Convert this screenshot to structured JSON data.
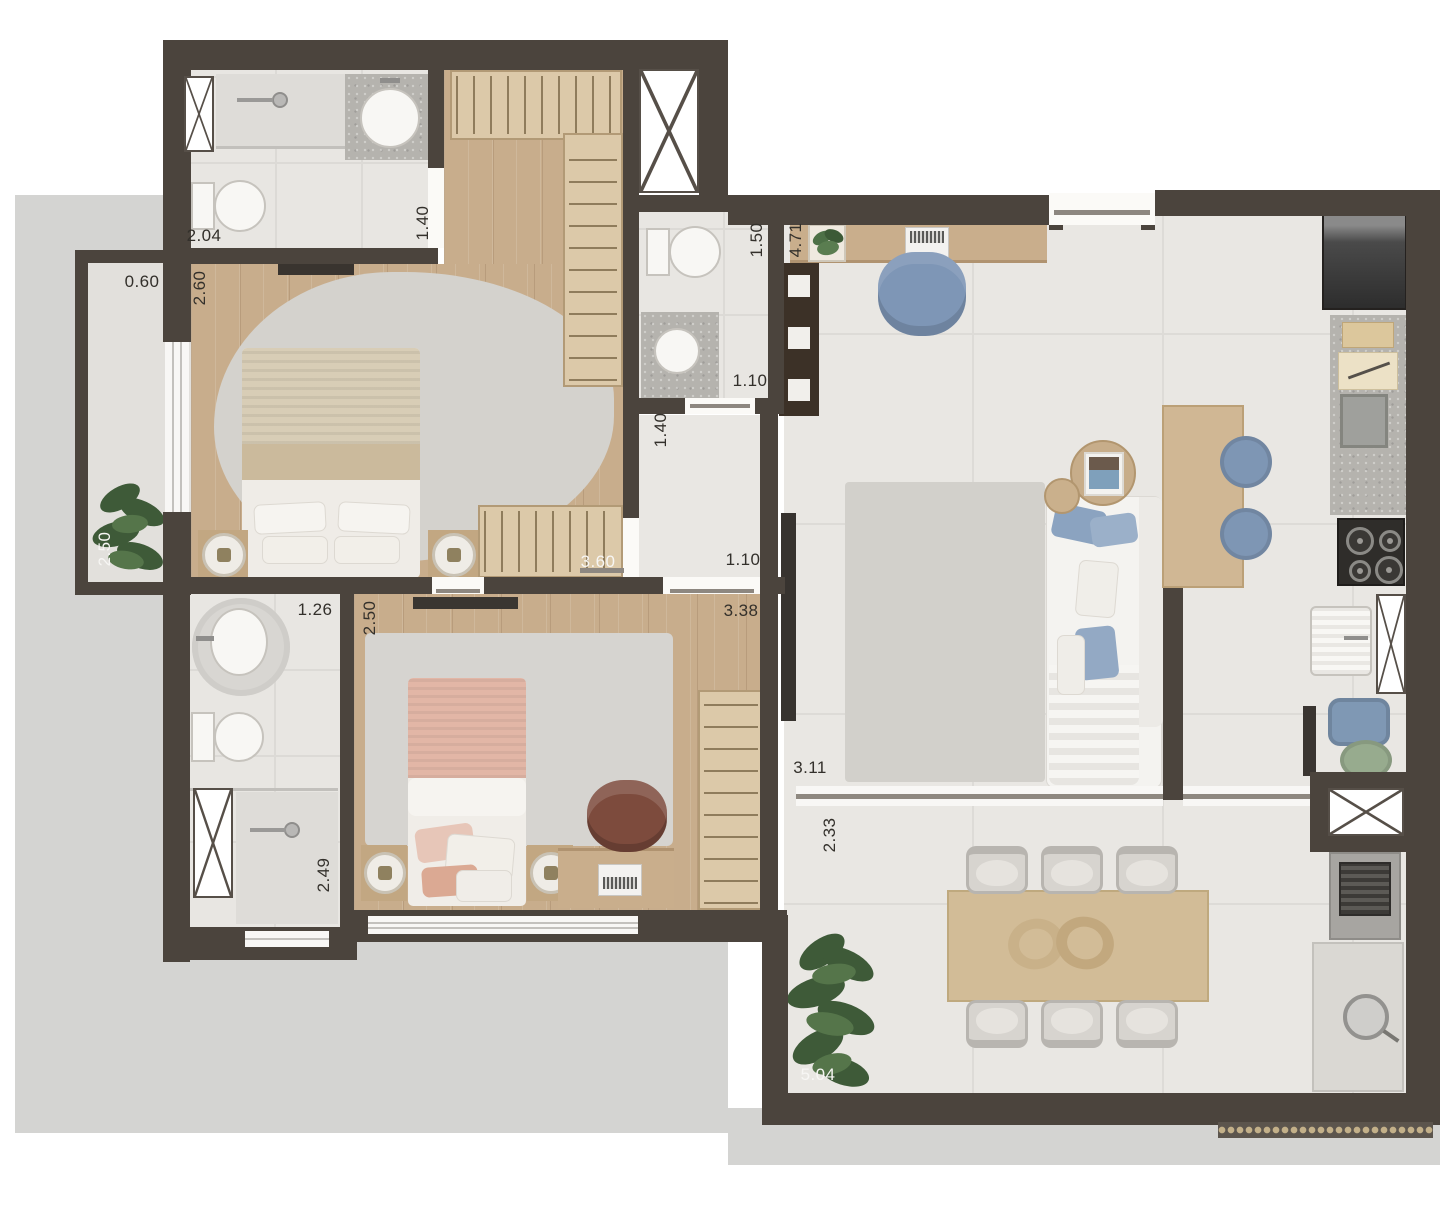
{
  "plan_type": "apartment-floor-plan",
  "dims": [
    {
      "text": "2.04",
      "orientation": "horizontal",
      "color": "dark",
      "area": "bathroom-1"
    },
    {
      "text": "1.40",
      "orientation": "vertical",
      "color": "dark",
      "area": "bathroom-1-door"
    },
    {
      "text": "0.60",
      "orientation": "horizontal",
      "color": "dark",
      "area": "balcony"
    },
    {
      "text": "2.60",
      "orientation": "vertical",
      "color": "dark",
      "area": "master-bedroom"
    },
    {
      "text": "2.50",
      "orientation": "vertical",
      "color": "light",
      "area": "balcony"
    },
    {
      "text": "1.50",
      "orientation": "vertical",
      "color": "dark",
      "area": "bathroom-2"
    },
    {
      "text": "4.71",
      "orientation": "vertical",
      "color": "dark",
      "area": "office-hall"
    },
    {
      "text": "1.10",
      "orientation": "horizontal",
      "color": "dark",
      "area": "bathroom-2-door"
    },
    {
      "text": "1.40",
      "orientation": "vertical",
      "color": "dark",
      "area": "corridor"
    },
    {
      "text": "1.10",
      "orientation": "horizontal",
      "color": "dark",
      "area": "bedroom-2-door"
    },
    {
      "text": "3.60",
      "orientation": "horizontal",
      "color": "light",
      "area": "master-wardrobe"
    },
    {
      "text": "2.50",
      "orientation": "vertical",
      "color": "dark",
      "area": "bedroom-2"
    },
    {
      "text": "1.26",
      "orientation": "horizontal",
      "color": "dark",
      "area": "bathroom-3"
    },
    {
      "text": "3.38",
      "orientation": "horizontal",
      "color": "dark",
      "area": "bedroom-2"
    },
    {
      "text": "2.49",
      "orientation": "vertical",
      "color": "dark",
      "area": "bathroom-3-shower"
    },
    {
      "text": "3.11",
      "orientation": "horizontal",
      "color": "dark",
      "area": "living-room"
    },
    {
      "text": "2.33",
      "orientation": "vertical",
      "color": "dark",
      "area": "terrace"
    },
    {
      "text": "5.04",
      "orientation": "horizontal",
      "color": "light",
      "area": "terrace"
    }
  ],
  "palette": {
    "wall": "#4b443d",
    "wood_floor": "#c8ad8c",
    "tile_floor": "#e9e7e3",
    "wardrobe": "#dcc9a9",
    "granite": "#b5b3ae",
    "accent_blue": "#7e96b5",
    "accent_pink": "#e2b6a6",
    "plant_green": "#4a6842",
    "slab": "#d4d4d2",
    "table_wood": "#d2bc97",
    "sofa_white": "#f4f3f0"
  }
}
